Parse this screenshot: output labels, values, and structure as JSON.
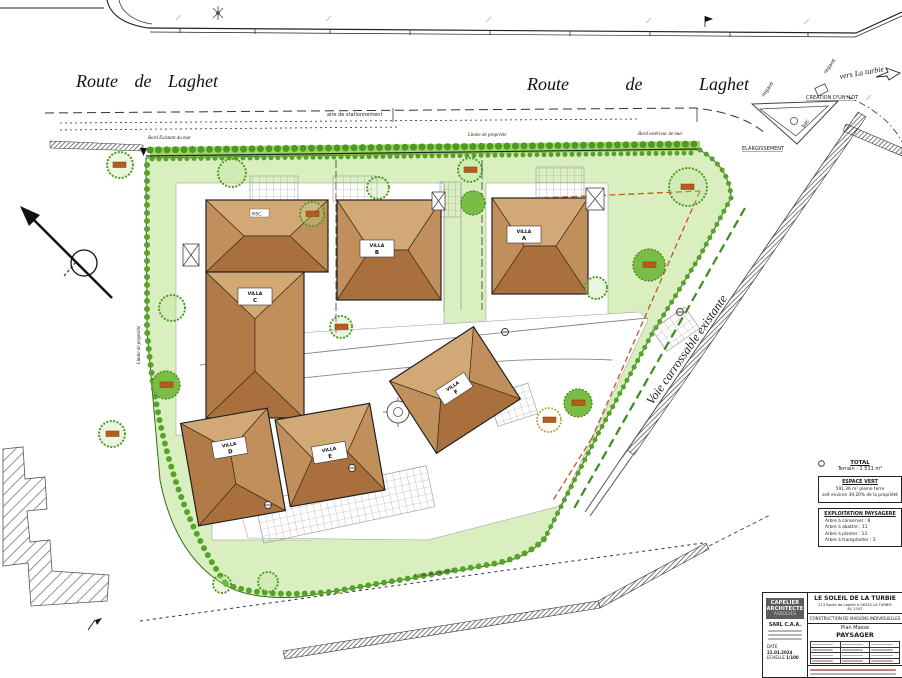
{
  "roads": {
    "route_left": "Route de Laghet",
    "route_right": "Route de Laghet",
    "vers_la_turbie": "vers La turbie",
    "voie_carrossable": "Voie carrossable existante",
    "aire_stationnement": "aire de stationnement",
    "elargissement": "ELARGISSEMENT",
    "creation_ilot": "CREATION D'UN ILOT",
    "regard1": "regard",
    "regard2": "regard",
    "bac": "bac"
  },
  "boundaries": {
    "limite_top": "Limite de propriété",
    "limite_left": "Limite de propriété",
    "limite_bottom": "Limite de propriété",
    "bord_existant": "Bord Existant du mur",
    "bord_exterieur": "Bord extérieur de mur"
  },
  "villas": [
    {
      "word": "VILLA",
      "letter": "C"
    },
    {
      "word": "VILLA",
      "letter": "B"
    },
    {
      "word": "VILLA",
      "letter": "A"
    },
    {
      "word": "VILLA",
      "letter": "F"
    },
    {
      "word": "VILLA",
      "letter": "D"
    },
    {
      "word": "VILLA",
      "letter": "E"
    }
  ],
  "annotations": {
    "pool": "PISC."
  },
  "legend": {
    "total_title": "TOTAL",
    "total_value": "Terrain : 1 511 m²",
    "espace_vert_title": "ESPACE VERT",
    "espace_vert_line1": "591,36 m² pleine terre",
    "espace_vert_line2": "soit environ 39,20% de la propriété",
    "exploitation_title": "EXPLOITATION PAYSAGERE",
    "items": [
      {
        "label": "Arbre à conserver : 8",
        "color": "#2e8b1e"
      },
      {
        "label": "Arbre à abattre : 11",
        "color": "#9aa12c"
      },
      {
        "label": "Arbre à planter : 13",
        "color": "#c96a1e"
      },
      {
        "label": "Arbre à transplanter : 3",
        "color": "#5a4b8a"
      }
    ]
  },
  "titleblock": {
    "firm1": "CAPELIER",
    "firm2": "ARCHITECTE",
    "firm3": "ASSOCIES",
    "company": "SARL C.A.A.",
    "project": "LE SOLEIL DE LA TURBIE",
    "address": "213 Route de Laghet à 06320 LA TURBIE",
    "ref": "AC 1107",
    "type": "CONSTRUCTION DE MAISONS INDIVIDUELLES",
    "drawing1": "Plan Masse",
    "drawing2": "PAYSAGER",
    "date_label": "DATE",
    "date": "21.01.2024",
    "scale_label": "ECHELLE",
    "scale": "1/100"
  }
}
